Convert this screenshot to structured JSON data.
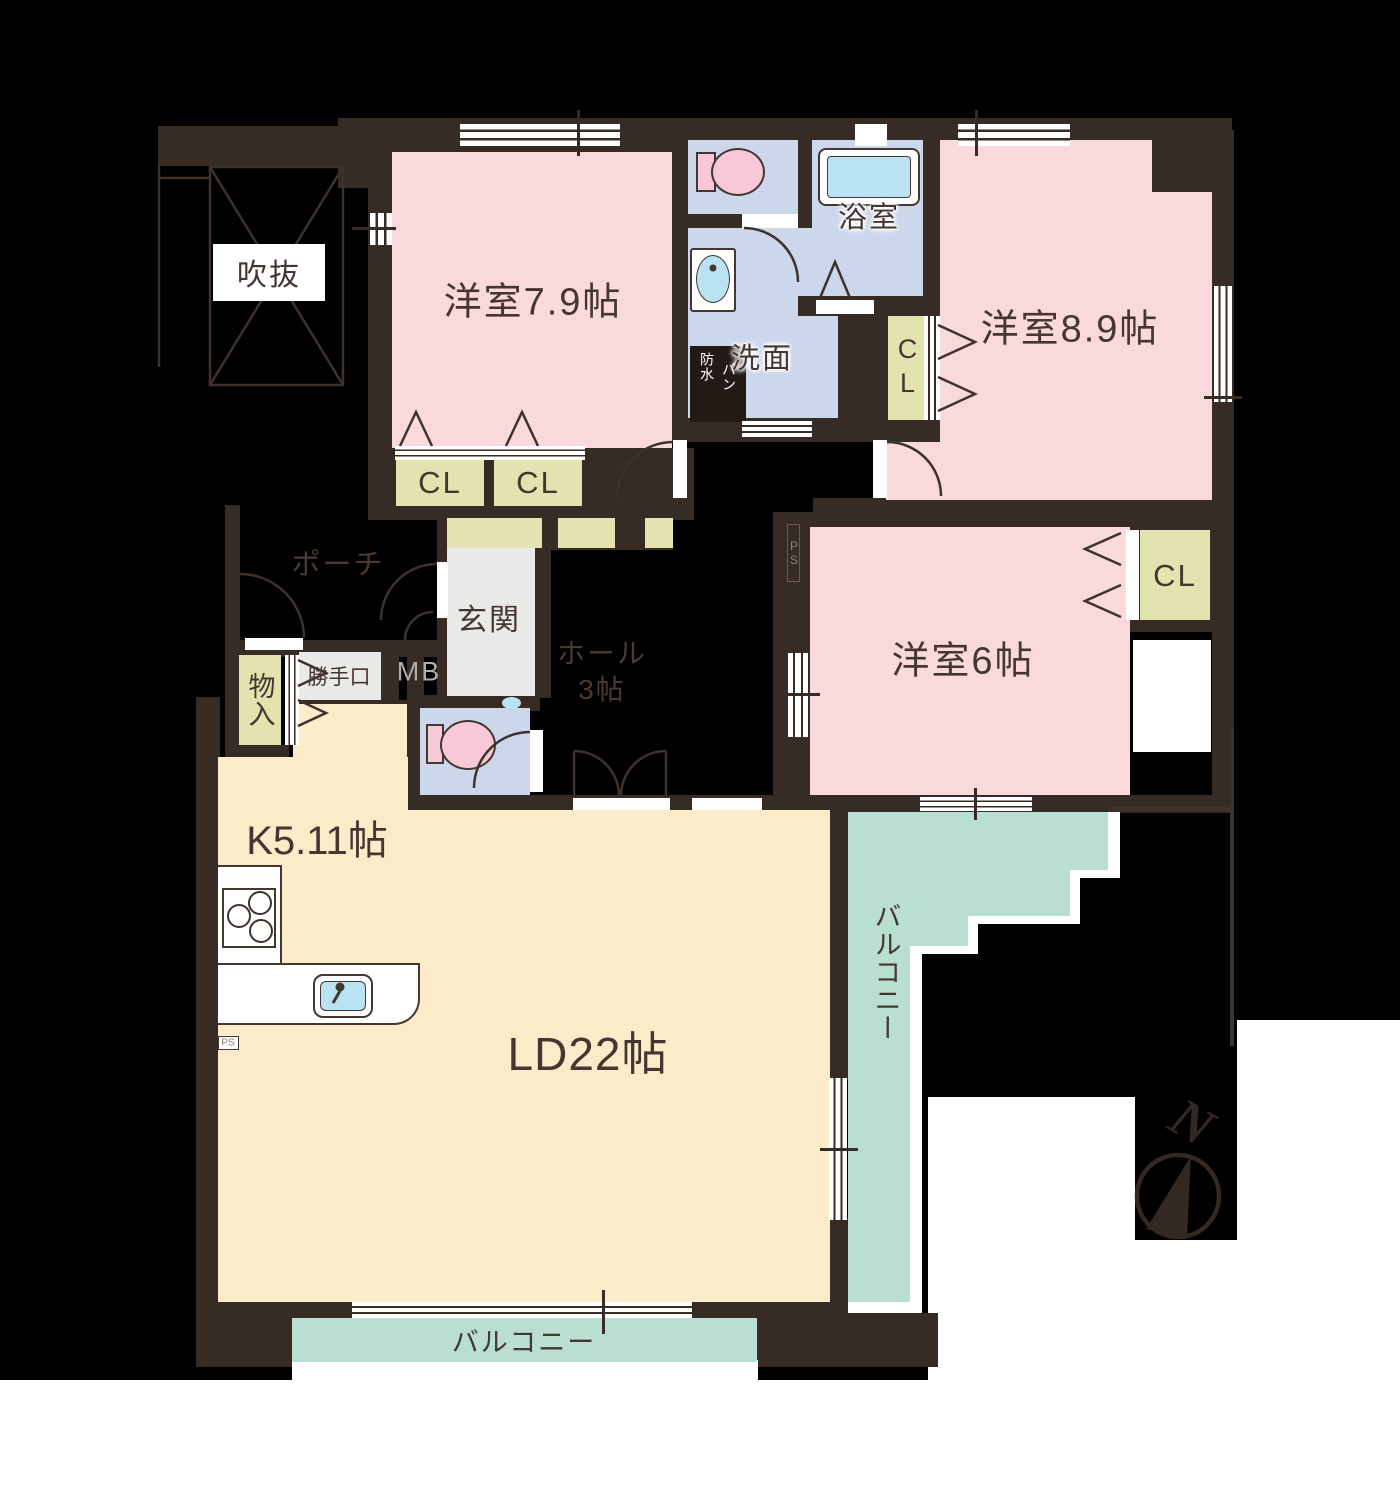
{
  "document_type": "floor-plan",
  "rooms": {
    "bedroom1": {
      "label": "洋室7.9帖"
    },
    "bedroom2": {
      "label": "洋室8.9帖"
    },
    "bedroom3": {
      "label": "洋室6帖"
    },
    "living_dining": {
      "label": "LD22帖"
    },
    "kitchen": {
      "label": "K5.11帖"
    },
    "hall": {
      "line1": "ホール",
      "line2": "3帖"
    },
    "entrance": {
      "label": "玄関"
    },
    "porch": {
      "label": "ポーチ"
    },
    "bathroom": {
      "label": "浴室"
    },
    "washroom": {
      "label": "洗面"
    },
    "waterproof_pan": {
      "line1": "防水",
      "line2": "パン"
    },
    "void_space": {
      "label": "吹抜"
    },
    "storage": {
      "label": "物入"
    },
    "back_door": {
      "label": "勝手口"
    },
    "meter_box": {
      "label": "MB"
    },
    "pipe_space": {
      "label": "PS"
    },
    "closet": {
      "label": "CL"
    },
    "balcony": {
      "label": "バルコニー"
    }
  },
  "compass": {
    "north_label": "N"
  },
  "colors": {
    "wall": "#372b25",
    "western_room": "#f9d9db",
    "wet_area": "#ccd7eb",
    "water_fixture": "#b9e2f2",
    "closet": "#e2e3ae",
    "wood_floor": "#fcebc9",
    "balcony": "#b9dfd3",
    "entrance_floor": "#e9e9e7",
    "background": "#000000",
    "page": "#ffffff"
  }
}
